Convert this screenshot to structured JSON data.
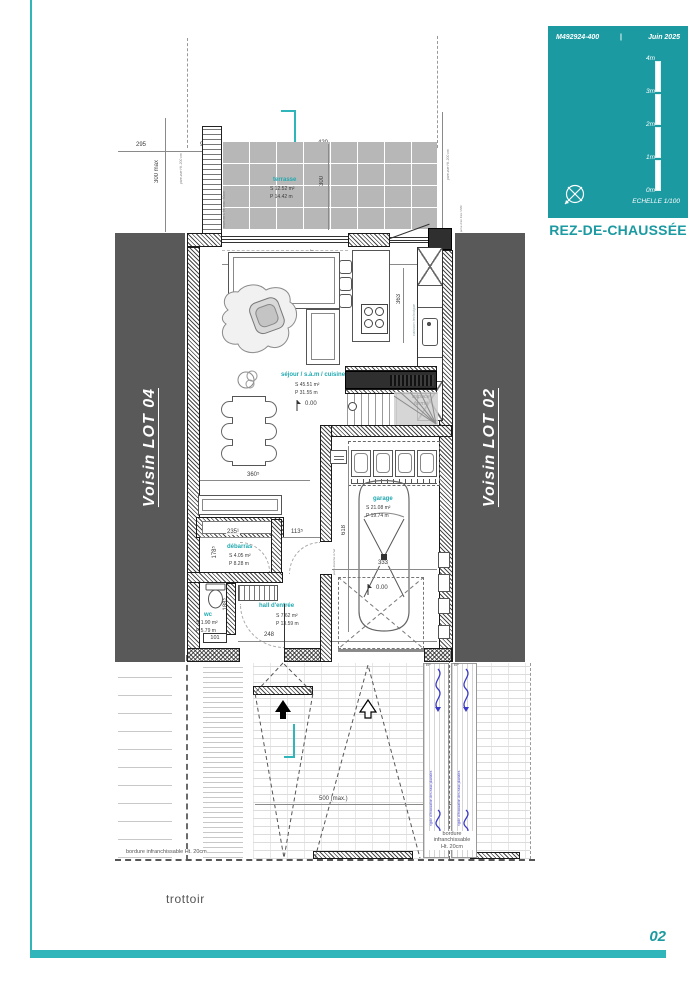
{
  "legend": {
    "code": "M492924-400",
    "sep": "|",
    "date": "Juin 2025",
    "scale_ticks": [
      "4m",
      "3m",
      "2m",
      "1m",
      "0m"
    ],
    "echelle": "ECHELLE  1/100",
    "title": "REZ-DE-CHAUSSÉE"
  },
  "page": {
    "number": "02",
    "trottoir": "trottoir"
  },
  "site": {
    "neighbor_left": "Voisin LOT 04",
    "neighbor_right": "Voisin LOT 02",
    "bordure_left": "bordure infranchissable Ht. 20cm",
    "bordure_right_line1": "bordure",
    "bordure_right_line2": "infranchissable",
    "bordure_right_line3": "Ht. 20cm",
    "rigole": "rigole d'évacuation des eaux pluviales",
    "ep": "EP"
  },
  "rooms": {
    "terrasse": {
      "name": "terrasse",
      "s": "S  12.52 m²",
      "p": "P  14.42 m"
    },
    "sejour": {
      "name": "séjour / s.à.m / cuisine",
      "s": "S  45.51 m²",
      "p": "P  31.55 m"
    },
    "garage": {
      "name": "garage",
      "s": "S  21.08 m²",
      "p": "P  19.74 m"
    },
    "debarras": {
      "name": "débarras",
      "s": "S  4.05 m²",
      "p": "P  8.28 m"
    },
    "wc": {
      "name": "wc",
      "s": "S  1.90 m²",
      "p": "P  5.79 m"
    },
    "hall": {
      "name": "hall d'entrée",
      "s": "S  7.62 m²",
      "p": "P  13.59 m"
    }
  },
  "levels": {
    "zero": "0.00"
  },
  "dims": {
    "d295": "295",
    "d99": "99",
    "d420": "420",
    "d300": "300",
    "d300max": "300 max",
    "d731": "731",
    "d363": "363",
    "d360": "360⁵",
    "d235": "235¹",
    "d113": "113⁵",
    "d178": "178⁵",
    "d188": "188⁵",
    "d101": "101",
    "d248": "248",
    "d618": "618",
    "d333": "333",
    "d500": "500 (max.)",
    "d84": "84"
  },
  "annotations": {
    "pare_vue": "pare-vue Ht. 200 cm",
    "murs_l": "murs en L Ht max. 50cm",
    "prise_air": "prise d'air frais VMC",
    "caisson": "caisson technique",
    "espace_ferme": "espace fermé",
    "porte_etanche": "porte étanche à l'air"
  },
  "icons": {
    "left_arrow": "←"
  },
  "colors": {
    "teal": "#1b9aa1",
    "room_label": "#21a9b0",
    "neighbor_band": "#595959",
    "drain_blue": "#3a3ac8",
    "terrace_gray": "#b7b7b7"
  }
}
